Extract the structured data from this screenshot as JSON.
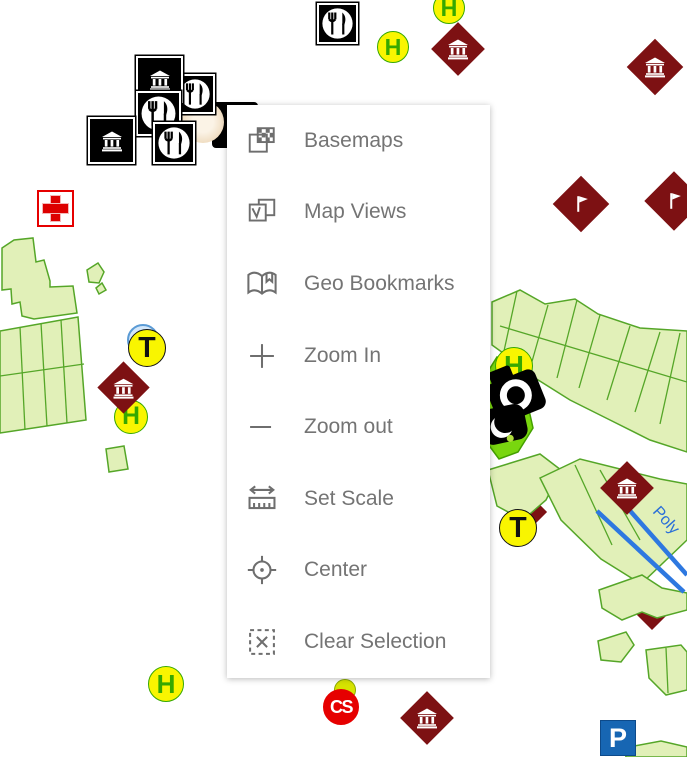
{
  "menu": {
    "items": [
      {
        "id": "basemaps",
        "label": "Basemaps"
      },
      {
        "id": "map-views",
        "label": "Map Views"
      },
      {
        "id": "geo-bookmarks",
        "label": "Geo Bookmarks"
      },
      {
        "id": "zoom-in",
        "label": "Zoom In"
      },
      {
        "id": "zoom-out",
        "label": "Zoom out"
      },
      {
        "id": "set-scale",
        "label": "Set Scale"
      },
      {
        "id": "center",
        "label": "Center"
      },
      {
        "id": "clear-selection",
        "label": "Clear Selection"
      }
    ]
  },
  "map": {
    "street_label": "Poly",
    "colors": {
      "poly_fill": "#e1f0b8",
      "poly_stroke": "#55a628",
      "bright_green_fill": "#79d60f",
      "bright_green_stroke": "#44a000",
      "diamond_red": "#7d1113",
      "marker_yellow": "#f9f500",
      "h_green": "#36a800",
      "cross_red": "#dd0000",
      "cs_red": "#e60000",
      "parking_blue": "#1766b3",
      "street_blue": "#2e78e0",
      "menu_text_gray": "#747474"
    },
    "shapes": [
      {
        "name": "left-block-a",
        "points": "2,248 14,240 33,238 36,262 44,260 50,281 50,287 73,286 77,313 34,319 22,316 20,302 12,304 11,289 2,290"
      },
      {
        "name": "left-band",
        "points": "0,331 78,317 86,420 40,427 0,433"
      },
      {
        "name": "left-bit-a",
        "points": "87,270 98,263 104,272 99,283 89,282"
      },
      {
        "name": "left-bit-b",
        "points": "96,288 102,283 106,290 99,294"
      },
      {
        "name": "small-rect",
        "points": "106,449 124,446 128,469 109,472"
      },
      {
        "name": "right-strip-band",
        "points": "492,302 520,290 545,304 575,299 598,314 640,328 687,331 687,452 650,440 610,420 570,400 535,378 510,358 492,345"
      },
      {
        "name": "diamond-small-occluded",
        "points": "531,497 546,512 531,527 516,512",
        "fill": "#7d1113",
        "stroke": "#7d1113"
      },
      {
        "name": "block-near-t",
        "points": "488,470 540,454 561,470 546,500 523,520 497,506"
      },
      {
        "name": "diamond-occluded-2",
        "points": "652,597 668,613 652,629 636,613",
        "fill": "#7d1113",
        "stroke": "#7d1113"
      },
      {
        "name": "lower-right-block",
        "points": "540,478 580,459 620,469 660,479 687,484 687,540 641,584 601,559 561,520"
      },
      {
        "name": "lower-right-block-b",
        "points": "599,590 642,575 662,588 687,593 687,610 657,618 642,612 622,620 602,608"
      },
      {
        "name": "lower-right-curve",
        "points": "598,641 626,632 634,645 621,662 601,660"
      },
      {
        "name": "lower-right-edge",
        "points": "646,650 681,645 687,652 687,690 666,695 649,678"
      },
      {
        "name": "below-parking",
        "points": "624,748 661,741 687,747 687,757 626,757"
      },
      {
        "name": "bright-green-blob",
        "points": "497,357 516,360 522,379 533,428 518,452 499,459 485,440 489,407 480,395 487,373",
        "fill": "#79d60f",
        "stroke": "#44a000"
      },
      {
        "name": "red-sliver",
        "points": "479,392 487,389 486,404",
        "fill": "#8b1111",
        "stroke": "#8b1111"
      }
    ],
    "detail_lines": [
      {
        "x1": 20,
        "y1": 327,
        "x2": 25,
        "y2": 430
      },
      {
        "x1": 41,
        "y1": 323,
        "x2": 47,
        "y2": 426
      },
      {
        "x1": 61,
        "y1": 320,
        "x2": 67,
        "y2": 423
      },
      {
        "x1": 0,
        "y1": 376,
        "x2": 84,
        "y2": 364
      },
      {
        "x1": 517,
        "y1": 291,
        "x2": 504,
        "y2": 351
      },
      {
        "x1": 548,
        "y1": 305,
        "x2": 531,
        "y2": 365
      },
      {
        "x1": 577,
        "y1": 300,
        "x2": 557,
        "y2": 378
      },
      {
        "x1": 600,
        "y1": 315,
        "x2": 579,
        "y2": 388
      },
      {
        "x1": 630,
        "y1": 326,
        "x2": 607,
        "y2": 400
      },
      {
        "x1": 660,
        "y1": 332,
        "x2": 635,
        "y2": 412
      },
      {
        "x1": 680,
        "y1": 333,
        "x2": 660,
        "y2": 424
      },
      {
        "x1": 500,
        "y1": 326,
        "x2": 687,
        "y2": 382
      },
      {
        "x1": 600,
        "y1": 470,
        "x2": 640,
        "y2": 540
      },
      {
        "x1": 575,
        "y1": 465,
        "x2": 612,
        "y2": 545
      },
      {
        "x1": 666,
        "y1": 648,
        "x2": 668,
        "y2": 693
      }
    ],
    "blue_lines": [
      {
        "x1": 609,
        "y1": 487,
        "x2": 687,
        "y2": 575
      },
      {
        "x1": 597,
        "y1": 511,
        "x2": 684,
        "y2": 592
      }
    ],
    "markers": [
      {
        "type": "restaurant-square",
        "x": 317,
        "y": 3,
        "size": 41
      },
      {
        "type": "circle",
        "letter": "H",
        "cx": 449,
        "cy": 8,
        "r": 16,
        "style": "h"
      },
      {
        "type": "circle",
        "letter": "H",
        "cx": 393,
        "cy": 47,
        "r": 16,
        "style": "h"
      },
      {
        "type": "museum-diamond",
        "cx": 458,
        "cy": 49,
        "side": 38
      },
      {
        "type": "museum-diamond",
        "cx": 655,
        "cy": 67,
        "side": 40
      },
      {
        "type": "dark-square",
        "x": 212,
        "y": 102,
        "size": 46
      },
      {
        "type": "cafe-circle",
        "cx": 203,
        "cy": 122,
        "r": 21
      },
      {
        "type": "restaurant-square",
        "x": 175,
        "y": 74,
        "size": 40
      },
      {
        "type": "museum-square",
        "x": 136,
        "y": 56,
        "size": 47
      },
      {
        "type": "restaurant-square",
        "x": 136,
        "y": 91,
        "size": 45
      },
      {
        "type": "restaurant-square",
        "x": 153,
        "y": 122,
        "size": 42
      },
      {
        "type": "museum-square",
        "x": 88,
        "y": 117,
        "size": 47
      },
      {
        "type": "red-cross",
        "x": 37,
        "y": 190,
        "size": 37
      },
      {
        "type": "flag-diamond",
        "cx": 581,
        "cy": 204,
        "side": 40
      },
      {
        "type": "flag-diamond",
        "cx": 674,
        "cy": 201,
        "side": 42
      },
      {
        "type": "blue-circle",
        "cx": 143,
        "cy": 340,
        "r": 16
      },
      {
        "type": "circle",
        "letter": "T",
        "cx": 147,
        "cy": 348,
        "r": 19,
        "style": "t"
      },
      {
        "type": "circle",
        "letter": "H",
        "cx": 131,
        "cy": 417,
        "r": 17,
        "style": "h"
      },
      {
        "type": "museum-diamond",
        "cx": 123,
        "cy": 387,
        "side": 37
      },
      {
        "type": "circle",
        "letter": "H",
        "cx": 514,
        "cy": 366,
        "r": 19,
        "style": "h"
      },
      {
        "type": "camera",
        "x": 478,
        "y": 356
      },
      {
        "type": "circle",
        "letter": "T",
        "cx": 518,
        "cy": 528,
        "r": 19,
        "style": "t"
      },
      {
        "type": "museum-diamond",
        "cx": 627,
        "cy": 488,
        "side": 38
      },
      {
        "type": "circle",
        "letter": "H",
        "cx": 166,
        "cy": 684,
        "r": 18,
        "style": "h"
      },
      {
        "type": "green-dome",
        "cx": 345,
        "cy": 690,
        "r": 11
      },
      {
        "type": "circle",
        "letter": "CS",
        "cx": 341,
        "cy": 707,
        "r": 18,
        "style": "cs"
      },
      {
        "type": "museum-diamond",
        "cx": 427,
        "cy": 718,
        "side": 38
      },
      {
        "type": "parking",
        "x": 600,
        "y": 720,
        "size": 36
      }
    ]
  }
}
